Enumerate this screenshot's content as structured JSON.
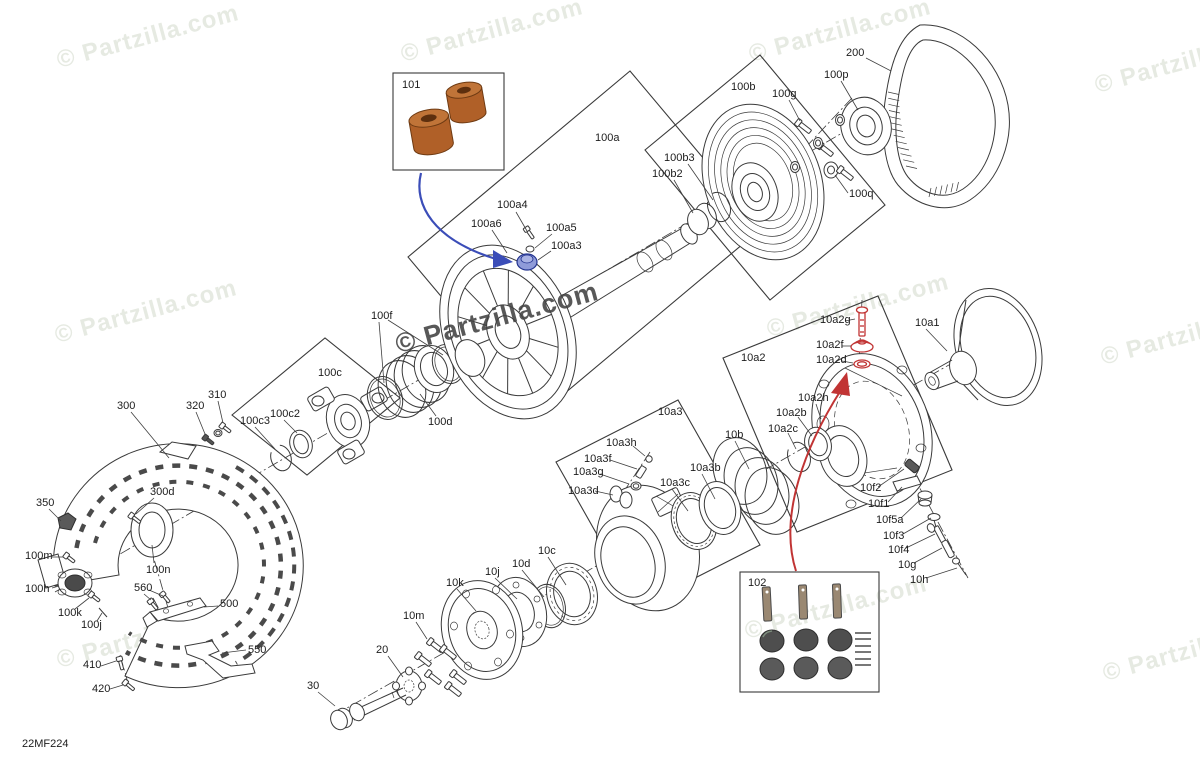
{
  "doc": {
    "code": "22MF224"
  },
  "watermark": {
    "text": "© Partzilla.com",
    "positions": [
      {
        "x": 148,
        "y": 37,
        "v": "light"
      },
      {
        "x": 492,
        "y": 31,
        "v": "light"
      },
      {
        "x": 840,
        "y": 31,
        "v": "light"
      },
      {
        "x": 1186,
        "y": 62,
        "v": "light"
      },
      {
        "x": 146,
        "y": 312,
        "v": "light"
      },
      {
        "x": 497,
        "y": 318,
        "v": "dark"
      },
      {
        "x": 858,
        "y": 306,
        "v": "light"
      },
      {
        "x": 1192,
        "y": 334,
        "v": "light"
      },
      {
        "x": 148,
        "y": 637,
        "v": "light"
      },
      {
        "x": 836,
        "y": 608,
        "v": "light"
      },
      {
        "x": 1194,
        "y": 650,
        "v": "light"
      }
    ]
  },
  "colors": {
    "light_wm": "#e6eae2",
    "dark_wm": "#414141",
    "line": "#3a3a3a",
    "blue": "#3b4db8",
    "blue_fill": "#8f9bd9",
    "red": "#c13434",
    "copper": "#b06028",
    "copper_top": "#c07438",
    "copper_hole": "#5d2f0e",
    "dark_fill": "#4e4e4e",
    "pin_fill": "#9a8872"
  },
  "arrows": [
    {
      "color_key": "blue",
      "from_box": "101",
      "points_to": "100a3"
    },
    {
      "color_key": "red",
      "from_box": "102",
      "points_to": "10a2"
    }
  ],
  "labels": [
    {
      "id": "101",
      "text": "101",
      "x": 402,
      "y": 80
    },
    {
      "id": "100a",
      "text": "100a",
      "x": 595,
      "y": 133
    },
    {
      "id": "100a4",
      "text": "100a4",
      "x": 497,
      "y": 200,
      "leaders": [
        [
          516,
          212,
          527,
          231
        ]
      ]
    },
    {
      "id": "100a6",
      "text": "100a6",
      "x": 471,
      "y": 219,
      "leaders": [
        [
          492,
          230,
          507,
          253
        ]
      ]
    },
    {
      "id": "100a5",
      "text": "100a5",
      "x": 546,
      "y": 223,
      "leaders": [
        [
          552,
          234,
          535,
          248
        ]
      ]
    },
    {
      "id": "100a3",
      "text": "100a3",
      "x": 551,
      "y": 241,
      "leaders": [
        [
          551,
          251,
          538,
          260
        ]
      ]
    },
    {
      "id": "100b",
      "text": "100b",
      "x": 731,
      "y": 82
    },
    {
      "id": "100b3",
      "text": "100b3",
      "x": 664,
      "y": 153,
      "leaders": [
        [
          688,
          164,
          713,
          200
        ]
      ]
    },
    {
      "id": "100b2",
      "text": "100b2",
      "x": 652,
      "y": 169,
      "leaders": [
        [
          674,
          180,
          693,
          213
        ]
      ]
    },
    {
      "id": "100g",
      "text": "100g",
      "x": 772,
      "y": 89,
      "leaders": [
        [
          789,
          100,
          800,
          121
        ]
      ]
    },
    {
      "id": "100p",
      "text": "100p",
      "x": 824,
      "y": 70,
      "leaders": [
        [
          841,
          81,
          858,
          110
        ]
      ]
    },
    {
      "id": "200",
      "text": "200",
      "x": 846,
      "y": 48,
      "leaders": [
        [
          866,
          58,
          891,
          71
        ]
      ]
    },
    {
      "id": "100q",
      "text": "100q",
      "x": 849,
      "y": 189,
      "leaders": [
        [
          848,
          193,
          835,
          175
        ]
      ]
    },
    {
      "id": "100f",
      "text": "100f",
      "x": 371,
      "y": 311,
      "leaders": [
        [
          379,
          322,
          384,
          383
        ],
        [
          388,
          320,
          443,
          355
        ]
      ]
    },
    {
      "id": "100c",
      "text": "100c",
      "x": 318,
      "y": 368
    },
    {
      "id": "100c3",
      "text": "100c3",
      "x": 240,
      "y": 416,
      "leaders": [
        [
          255,
          427,
          275,
          449
        ]
      ]
    },
    {
      "id": "100c2",
      "text": "100c2",
      "x": 270,
      "y": 409,
      "leaders": [
        [
          284,
          420,
          297,
          433
        ]
      ]
    },
    {
      "id": "100d",
      "text": "100d",
      "x": 428,
      "y": 417,
      "leaders": [
        [
          436,
          416,
          420,
          394
        ]
      ]
    },
    {
      "id": "300",
      "text": "300",
      "x": 117,
      "y": 401,
      "leaders": [
        [
          131,
          412,
          169,
          458
        ]
      ]
    },
    {
      "id": "320",
      "text": "320",
      "x": 186,
      "y": 401,
      "leaders": [
        [
          196,
          412,
          205,
          434
        ]
      ]
    },
    {
      "id": "310",
      "text": "310",
      "x": 208,
      "y": 390,
      "leaders": [
        [
          218,
          401,
          223,
          423
        ]
      ]
    },
    {
      "id": "300d",
      "text": "300d",
      "x": 150,
      "y": 487,
      "leaders": [
        [
          154,
          498,
          136,
          514
        ]
      ]
    },
    {
      "id": "350",
      "text": "350",
      "x": 36,
      "y": 498,
      "leaders": [
        [
          49,
          509,
          61,
          521
        ]
      ]
    },
    {
      "id": "100m",
      "text": "100m",
      "x": 25,
      "y": 551,
      "leaders": [
        [
          52,
          557,
          63,
          557
        ]
      ]
    },
    {
      "id": "100h",
      "text": "100h",
      "x": 25,
      "y": 584,
      "leaders": [
        [
          52,
          588,
          59,
          586
        ]
      ]
    },
    {
      "id": "100k",
      "text": "100k",
      "x": 58,
      "y": 608,
      "leaders": [
        [
          75,
          609,
          89,
          598
        ]
      ]
    },
    {
      "id": "100j",
      "text": "100j",
      "x": 81,
      "y": 620,
      "leaders": [
        [
          97,
          621,
          102,
          613
        ]
      ]
    },
    {
      "id": "100n",
      "text": "100n",
      "x": 146,
      "y": 565,
      "leaders": [
        [
          154,
          563,
          152,
          545
        ]
      ]
    },
    {
      "id": "560",
      "text": "560",
      "x": 134,
      "y": 583,
      "leaders": [
        [
          144,
          594,
          151,
          600
        ],
        [
          149,
          590,
          163,
          596
        ]
      ]
    },
    {
      "id": "500",
      "text": "500",
      "x": 220,
      "y": 599,
      "leaders": [
        [
          218,
          606,
          204,
          607
        ]
      ]
    },
    {
      "id": "550",
      "text": "550",
      "x": 248,
      "y": 645,
      "leaders": [
        [
          246,
          650,
          222,
          653
        ]
      ]
    },
    {
      "id": "410",
      "text": "410",
      "x": 83,
      "y": 660,
      "leaders": [
        [
          101,
          666,
          116,
          661
        ]
      ]
    },
    {
      "id": "420",
      "text": "420",
      "x": 92,
      "y": 684,
      "leaders": [
        [
          110,
          689,
          123,
          685
        ]
      ]
    },
    {
      "id": "10k",
      "text": "10k",
      "x": 446,
      "y": 578,
      "leaders": [
        [
          457,
          589,
          476,
          611
        ]
      ]
    },
    {
      "id": "10j",
      "text": "10j",
      "x": 485,
      "y": 567,
      "leaders": [
        [
          495,
          578,
          517,
          599
        ]
      ]
    },
    {
      "id": "10d",
      "text": "10d",
      "x": 512,
      "y": 559,
      "leaders": [
        [
          522,
          570,
          544,
          597
        ]
      ]
    },
    {
      "id": "10c",
      "text": "10c",
      "x": 538,
      "y": 546,
      "leaders": [
        [
          548,
          557,
          566,
          585
        ]
      ]
    },
    {
      "id": "10m",
      "text": "10m",
      "x": 403,
      "y": 611,
      "leaders": [
        [
          416,
          622,
          427,
          639
        ]
      ]
    },
    {
      "id": "20",
      "text": "20",
      "x": 376,
      "y": 645,
      "leaders": [
        [
          388,
          656,
          403,
          677
        ]
      ]
    },
    {
      "id": "30",
      "text": "30",
      "x": 307,
      "y": 681,
      "leaders": [
        [
          318,
          692,
          335,
          706
        ]
      ]
    },
    {
      "id": "10a3",
      "text": "10a3",
      "x": 658,
      "y": 407
    },
    {
      "id": "10a3h",
      "text": "10a3h",
      "x": 606,
      "y": 438,
      "leaders": [
        [
          633,
          446,
          645,
          456
        ]
      ]
    },
    {
      "id": "10a3f",
      "text": "10a3f",
      "x": 584,
      "y": 454,
      "leaders": [
        [
          610,
          460,
          637,
          469
        ]
      ]
    },
    {
      "id": "10a3g",
      "text": "10a3g",
      "x": 573,
      "y": 467,
      "leaders": [
        [
          600,
          474,
          629,
          484
        ]
      ]
    },
    {
      "id": "10a3d",
      "text": "10a3d",
      "x": 568,
      "y": 486,
      "leaders": [
        [
          595,
          491,
          613,
          495
        ]
      ]
    },
    {
      "id": "10a3c",
      "text": "10a3c",
      "x": 660,
      "y": 478,
      "leaders": [
        [
          672,
          489,
          688,
          511
        ]
      ]
    },
    {
      "id": "10a3b",
      "text": "10a3b",
      "x": 690,
      "y": 463,
      "leaders": [
        [
          702,
          474,
          715,
          499
        ]
      ]
    },
    {
      "id": "10b",
      "text": "10b",
      "x": 725,
      "y": 430,
      "leaders": [
        [
          735,
          441,
          749,
          469
        ]
      ]
    },
    {
      "id": "10a2",
      "text": "10a2",
      "x": 741,
      "y": 353
    },
    {
      "id": "10a2g",
      "text": "10a2g",
      "x": 820,
      "y": 315,
      "leaders": [
        [
          845,
          321,
          855,
          319
        ]
      ]
    },
    {
      "id": "10a2f",
      "text": "10a2f",
      "x": 816,
      "y": 340,
      "leaders": [
        [
          842,
          346,
          851,
          346
        ]
      ]
    },
    {
      "id": "10a2d",
      "text": "10a2d",
      "x": 816,
      "y": 355,
      "leaders": [
        [
          842,
          361,
          853,
          363
        ]
      ]
    },
    {
      "id": "10a2h",
      "text": "10a2h",
      "x": 798,
      "y": 393,
      "leaders": [
        [
          816,
          404,
          821,
          419
        ]
      ]
    },
    {
      "id": "10a2b",
      "text": "10a2b",
      "x": 776,
      "y": 408,
      "leaders": [
        [
          798,
          417,
          812,
          436
        ]
      ]
    },
    {
      "id": "10a2c",
      "text": "10a2c",
      "x": 768,
      "y": 424,
      "leaders": [
        [
          788,
          433,
          796,
          449
        ]
      ]
    },
    {
      "id": "10a1",
      "text": "10a1",
      "x": 915,
      "y": 318,
      "leaders": [
        [
          926,
          329,
          947,
          351
        ]
      ]
    },
    {
      "id": "10f2",
      "text": "10f2",
      "x": 860,
      "y": 483,
      "leaders": [
        [
          878,
          487,
          904,
          469
        ]
      ]
    },
    {
      "id": "10f1",
      "text": "10f1",
      "x": 868,
      "y": 499,
      "leaders": [
        [
          888,
          502,
          902,
          487
        ]
      ]
    },
    {
      "id": "10f5a",
      "text": "10f5a",
      "x": 876,
      "y": 515,
      "leaders": [
        [
          901,
          518,
          921,
          499
        ]
      ]
    },
    {
      "id": "10f3",
      "text": "10f3",
      "x": 883,
      "y": 531,
      "leaders": [
        [
          903,
          534,
          931,
          518
        ]
      ]
    },
    {
      "id": "10f4",
      "text": "10f4",
      "x": 888,
      "y": 545,
      "leaders": [
        [
          906,
          548,
          935,
          534
        ]
      ]
    },
    {
      "id": "10g",
      "text": "10g",
      "x": 898,
      "y": 560,
      "leaders": [
        [
          914,
          563,
          942,
          548
        ]
      ]
    },
    {
      "id": "10h",
      "text": "10h",
      "x": 910,
      "y": 575,
      "leaders": [
        [
          926,
          578,
          957,
          568
        ]
      ]
    },
    {
      "id": "102",
      "text": "102",
      "x": 748,
      "y": 578
    }
  ]
}
